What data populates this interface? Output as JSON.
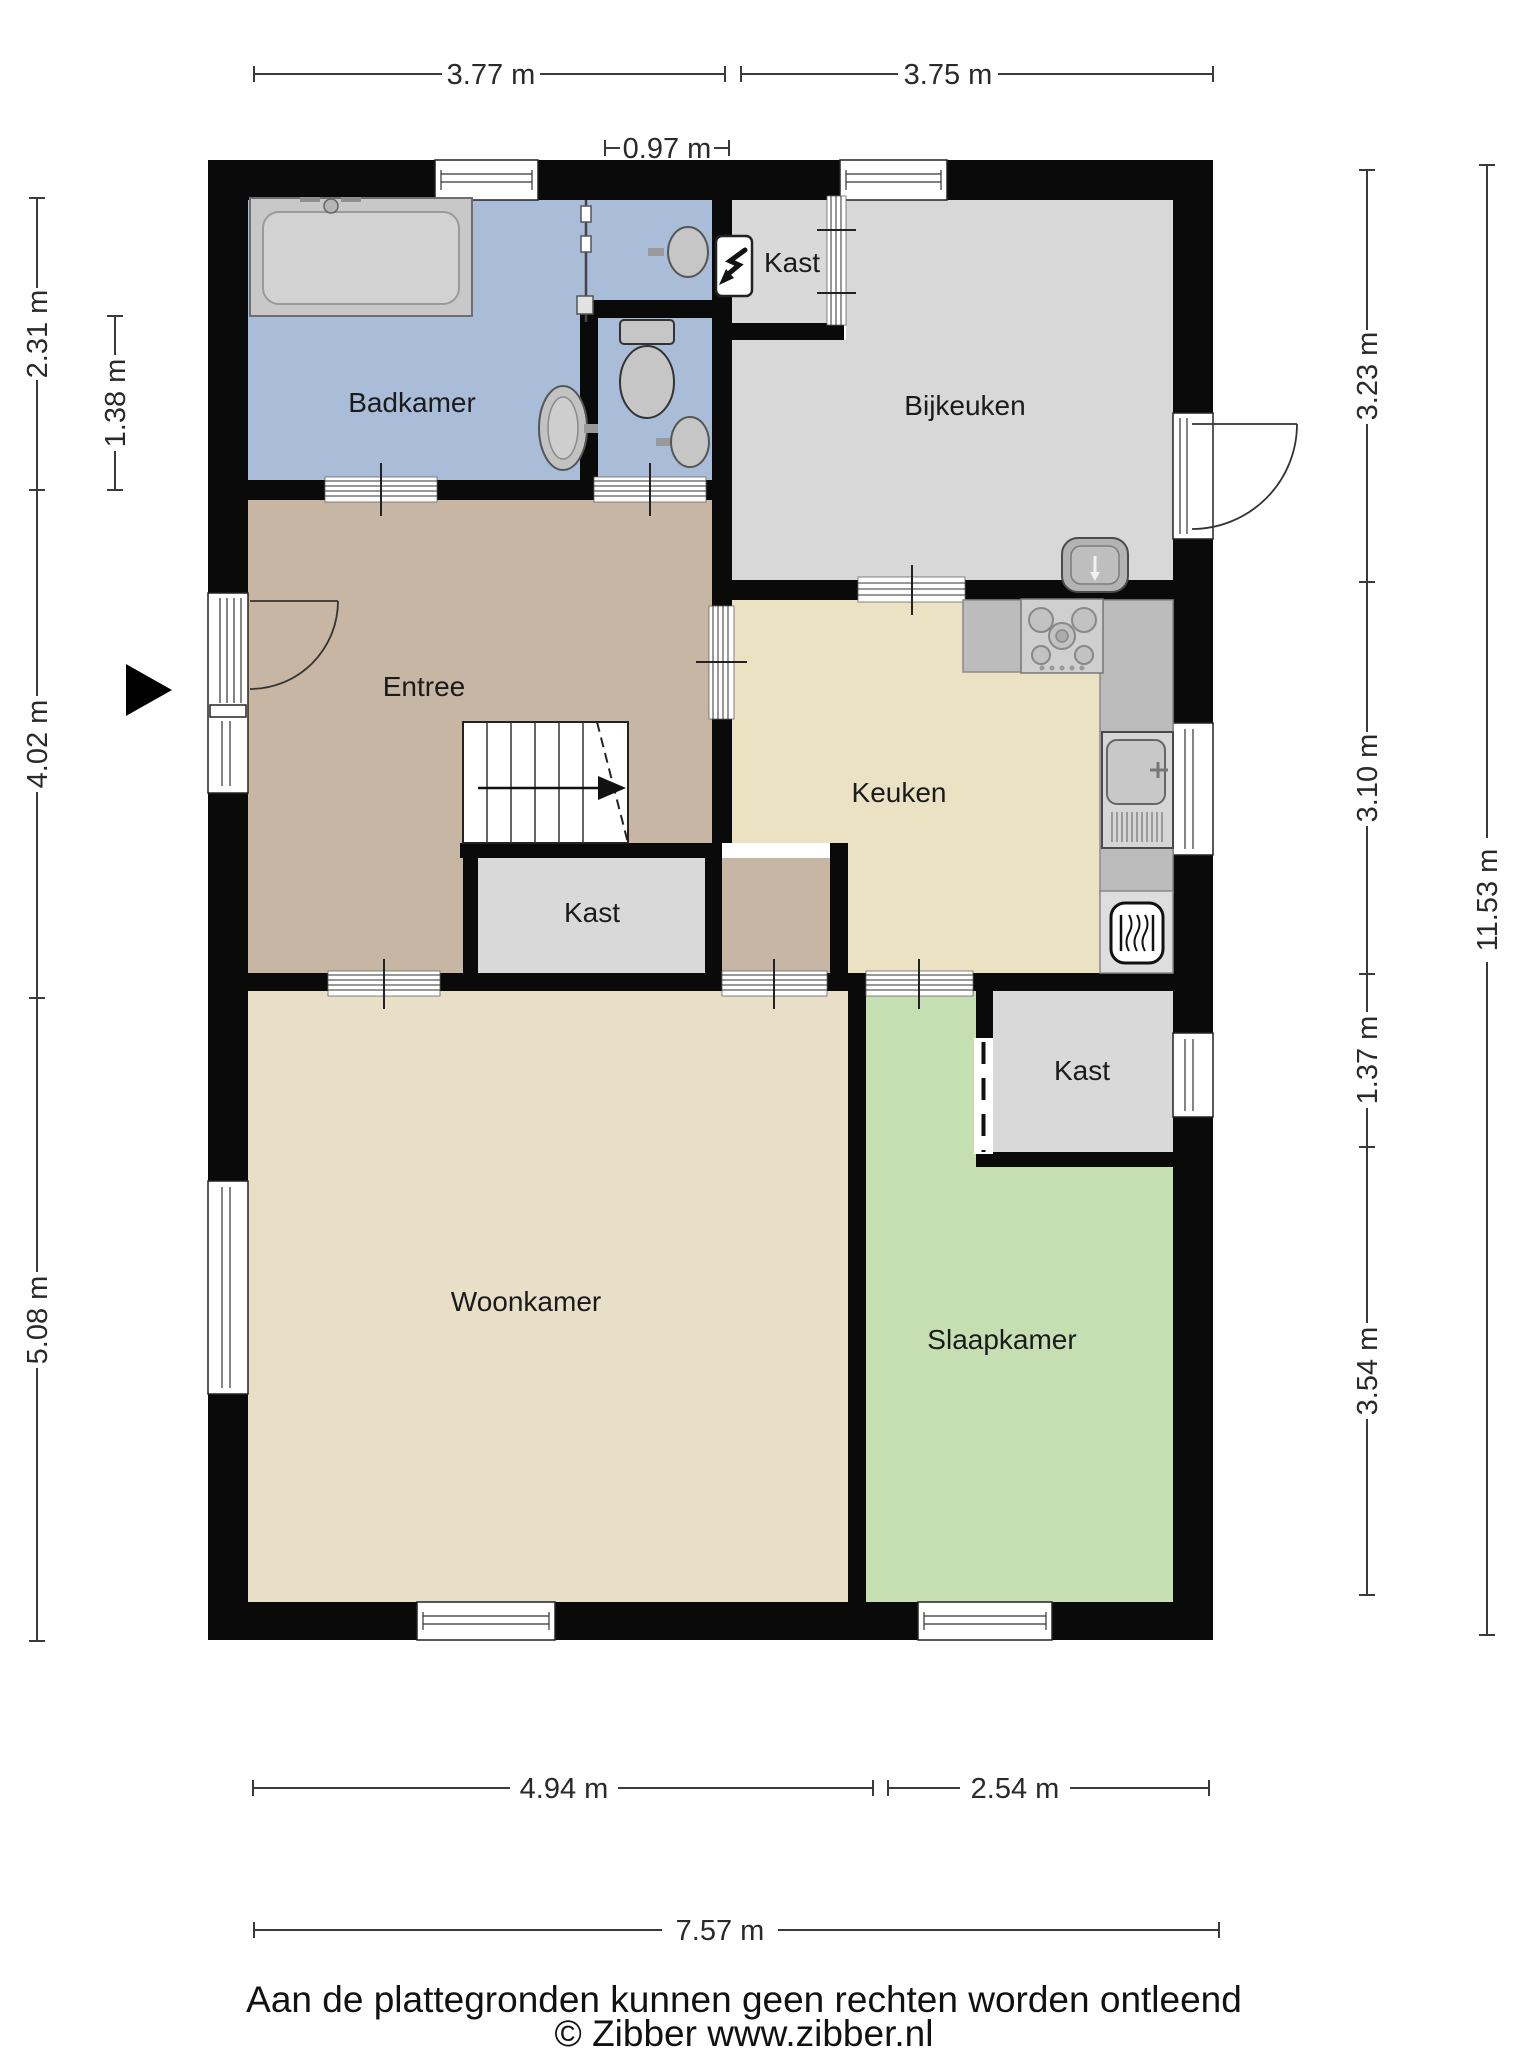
{
  "plan": {
    "rooms": {
      "badkamer": {
        "label": "Badkamer"
      },
      "kast_top": {
        "label": "Kast"
      },
      "bijkeuken": {
        "label": "Bijkeuken"
      },
      "entree": {
        "label": "Entree"
      },
      "keuken": {
        "label": "Keuken"
      },
      "kast_middle": {
        "label": "Kast"
      },
      "kast_right": {
        "label": "Kast"
      },
      "woonkamer": {
        "label": "Woonkamer"
      },
      "slaapkamer": {
        "label": "Slaapkamer"
      }
    },
    "dimensions": {
      "top1": "3.77 m",
      "top2": "3.75 m",
      "top_window": "0.97 m",
      "left1": "2.31 m",
      "left_inner": "1.38 m",
      "left2": "4.02 m",
      "left3": "5.08 m",
      "right1": "3.23 m",
      "right2": "3.10 m",
      "right3": "1.37 m",
      "right4": "3.54 m",
      "right_total": "11.53 m",
      "bottom1": "4.94 m",
      "bottom2": "2.54 m",
      "bottom_total": "7.57 m"
    },
    "colors": {
      "wall": "#0a0a0a",
      "badkamer": "#a9bdd9",
      "bijkeuken": "#d8d8d8",
      "kast": "#d9d9d9",
      "entree": "#c6b6a3",
      "keuken": "#ebe2c3",
      "woonkamer": "#e7dfc8",
      "slaapkamer": "#c6dfb2",
      "counter": "#bcbcbc",
      "fixture": "#c8c8c8"
    },
    "footer": {
      "disclaimer": "Aan de plattegronden kunnen geen rechten worden ontleend",
      "credit": "© Zibber www.zibber.nl"
    }
  }
}
